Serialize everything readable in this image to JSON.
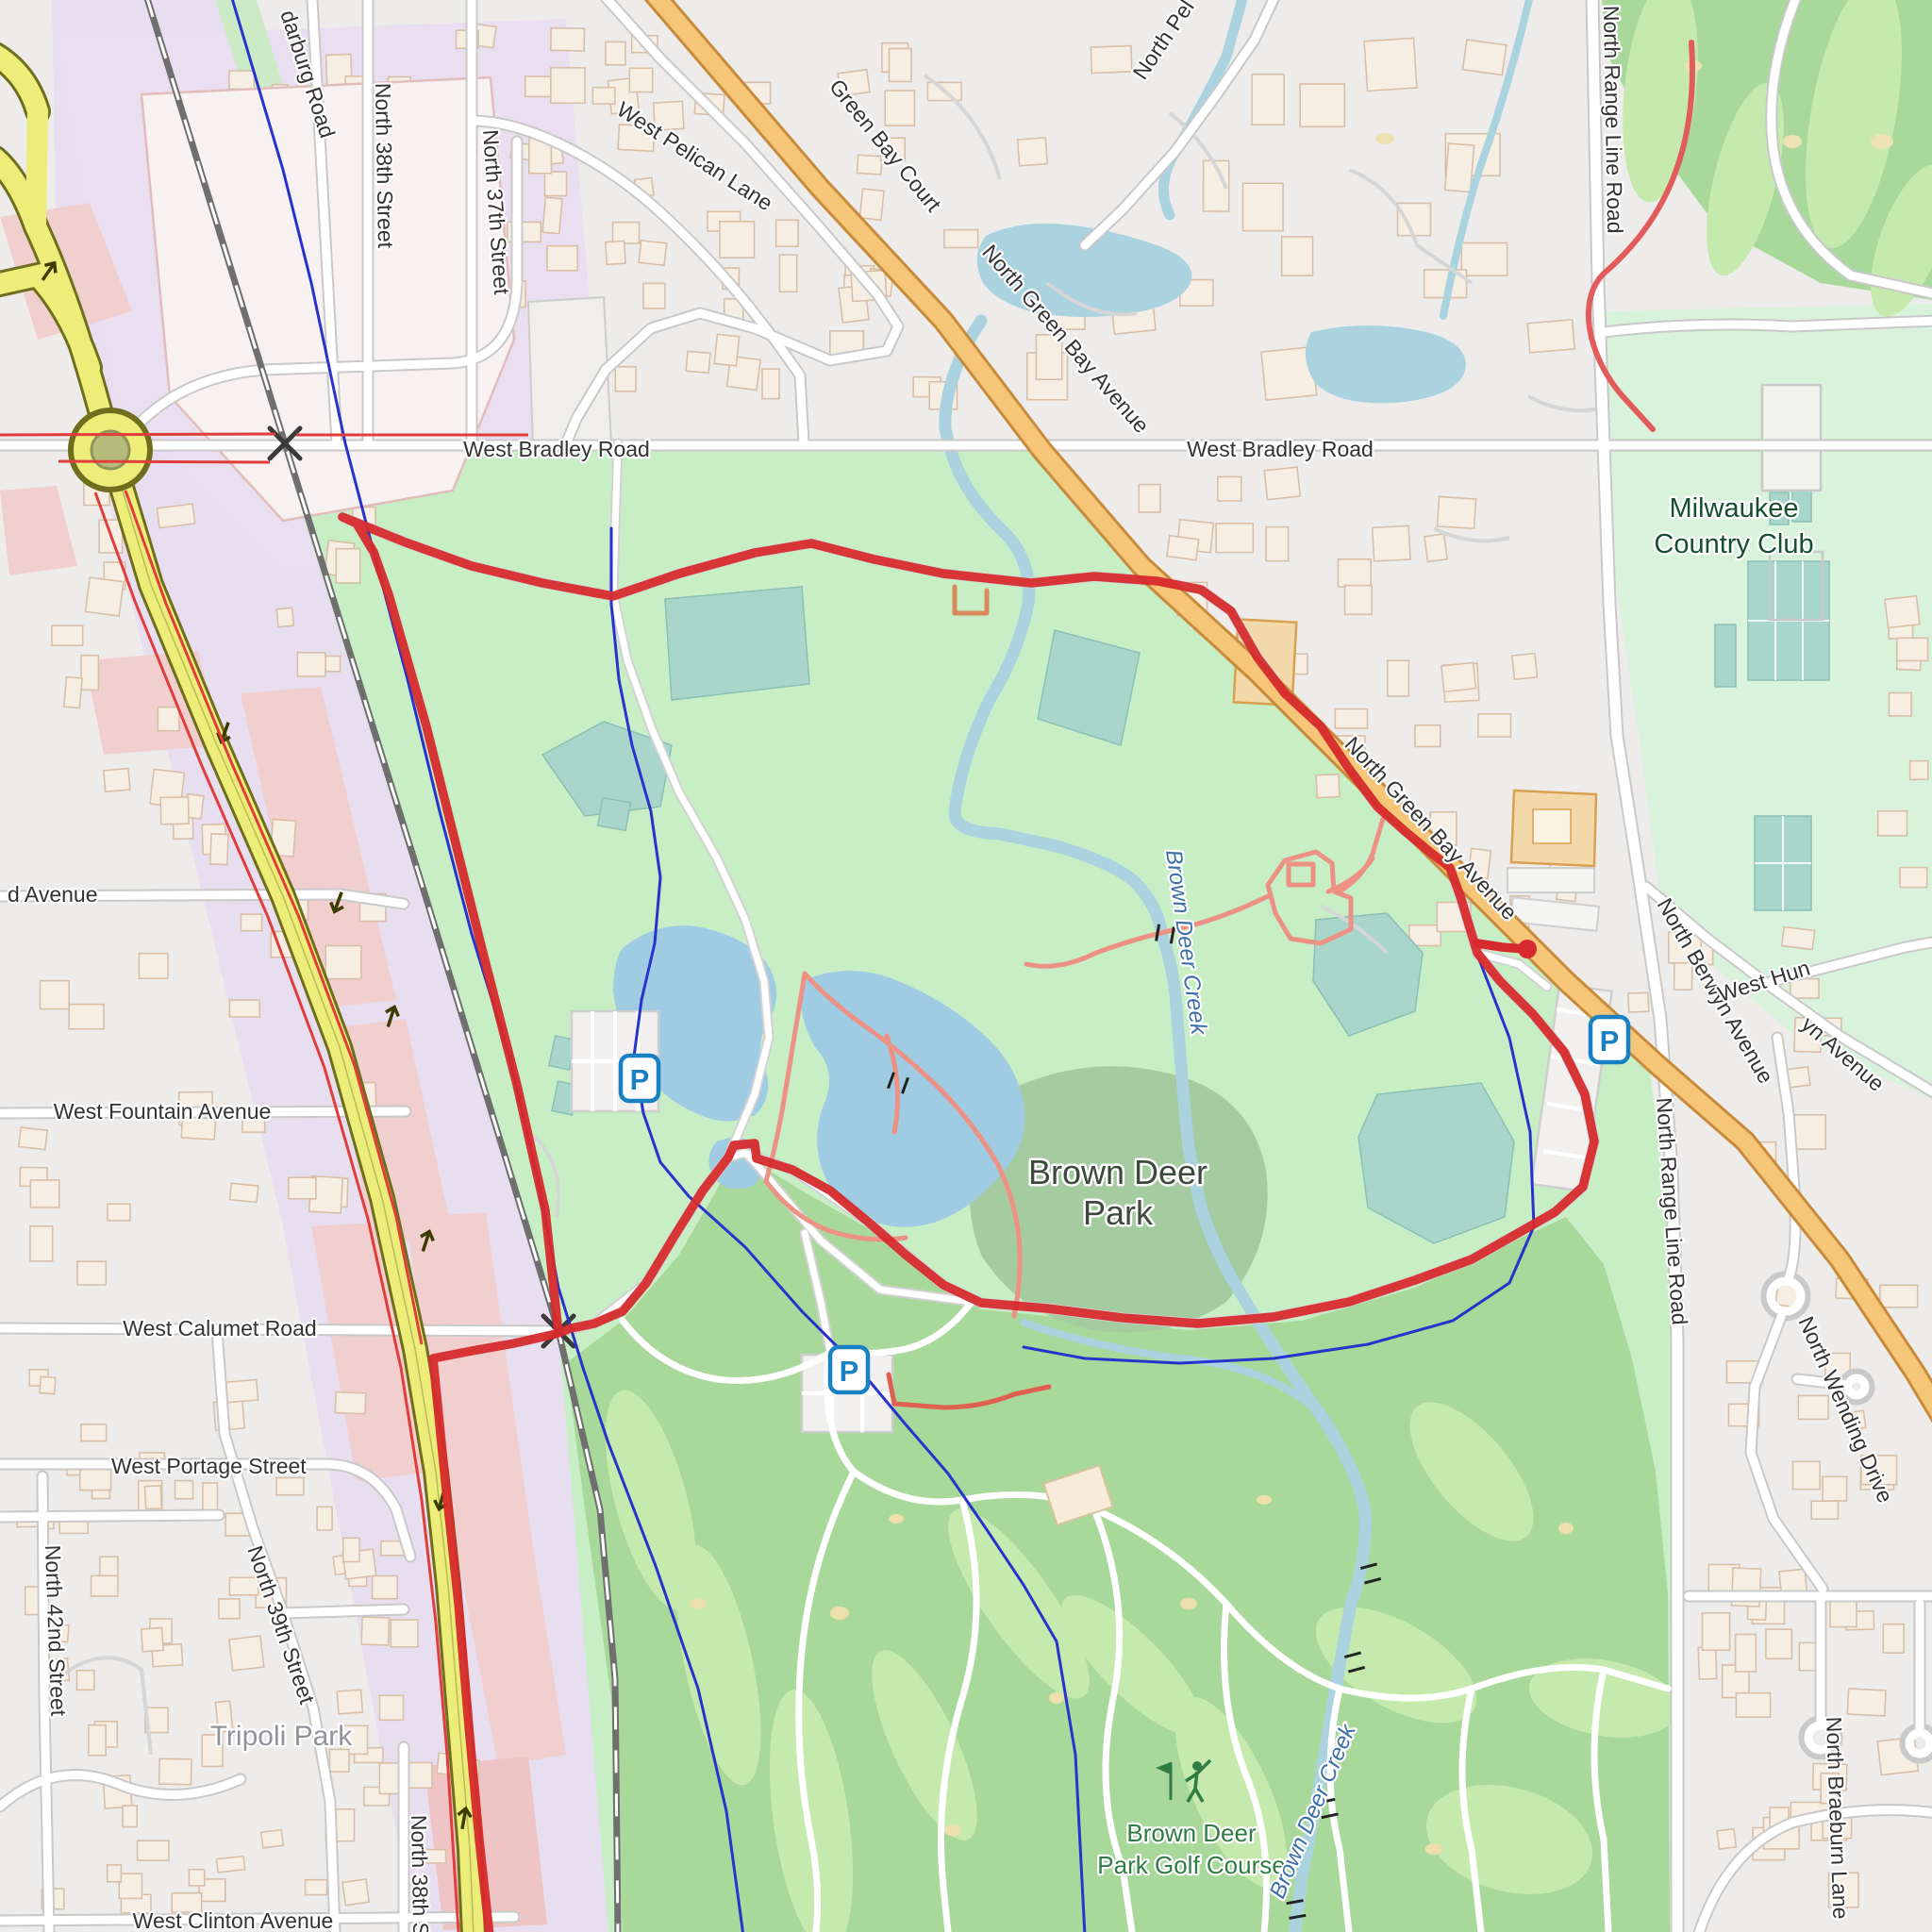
{
  "map": {
    "description": "Street map of Brown Deer Park area, Milwaukee, with red cycling route loop around the park",
    "labels": {
      "bradley": "West Bradley Road",
      "green_bay_ave": "North Green Bay Avenue",
      "green_bay_court": "Green Bay Court",
      "pelican": "West Pelican Lane",
      "north_pel": "North Pel",
      "darburg": "darburg Road",
      "n37": "North 37th Street",
      "n38": "North 38th Street",
      "n39": "North 39th Street",
      "n42": "North 42nd Street",
      "range_line": "North Range Line Road",
      "berwyn": "North Berwyn Avenue",
      "berwyn_partial": "yn Avenue",
      "west_hun": "West Hun",
      "wending": "North Wending Drive",
      "braeburn": "North Braeburn Lane",
      "fountain": "West Fountain Avenue",
      "d_avenue": "d Avenue",
      "calumet": "West Calumet Road",
      "portage": "West Portage Street",
      "clinton": "West Clinton Avenue",
      "tripoli": "Tripoli Park",
      "mcc_line1": "Milwaukee",
      "mcc_line2": "Country Club",
      "bdp_line1": "Brown Deer",
      "bdp_line2": "Park",
      "golf_line1": "Brown Deer",
      "golf_line2": "Park Golf Course",
      "creek": "Brown Deer Creek",
      "parking": "P"
    },
    "colors": {
      "route_red": "#d62a2c",
      "water": "#aad3df",
      "stream_dark": "#2733cc",
      "park_green": "#c8eec5",
      "golf_green": "#a9d89b",
      "highway_yellow": "#eded7a",
      "primary_orange": "#f5c678",
      "railway_gray": "#6f6f6f",
      "residential": "#edecea",
      "corridor_lavender": "#e7def0",
      "commercial_pink": "#f2cfcf",
      "sport_teal": "#a8d6cb"
    }
  }
}
